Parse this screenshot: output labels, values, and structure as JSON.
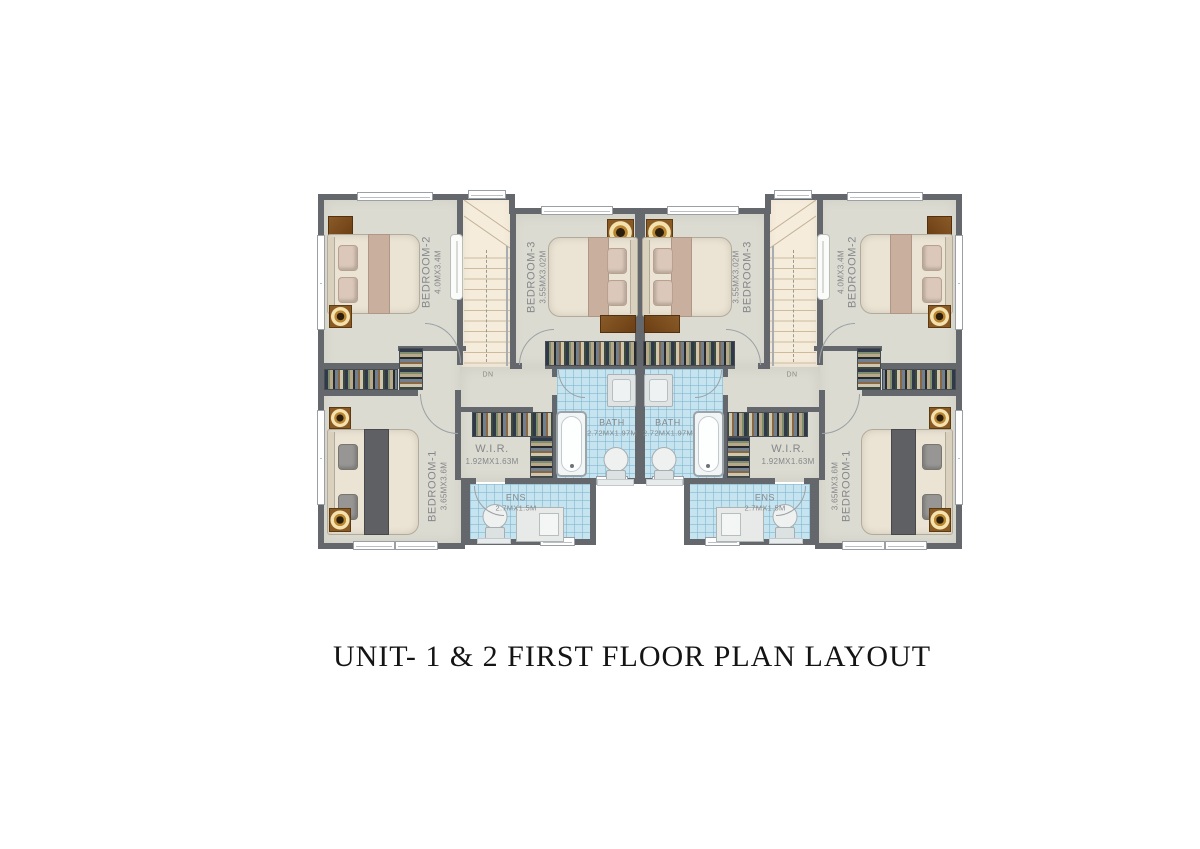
{
  "title": "UNIT- 1 & 2 FIRST FLOOR PLAN LAYOUT",
  "plan": {
    "stairs_label": "DN",
    "units": [
      {
        "id": "unit-1",
        "side": "left"
      },
      {
        "id": "unit-2",
        "side": "right"
      }
    ],
    "rooms": {
      "bedroom1": {
        "name": "BEDROOM-1",
        "dims": "3.65MX3.6M"
      },
      "bedroom2": {
        "name": "BEDROOM-2",
        "dims": "4.0MX3.4M"
      },
      "bedroom3": {
        "name": "BEDROOM-3",
        "dims": "3.55MX3.02M"
      },
      "wir": {
        "name": "W.I.R.",
        "dims": "1.92MX1.63M"
      },
      "bath": {
        "name": "BATH",
        "dims": "2.72MX1.97M"
      },
      "ens": {
        "name": "ENS",
        "dims": "2.7MX1.5M"
      }
    },
    "colors": {
      "floor": "#dbdbd1",
      "wall": "#64676c",
      "stair_floor": "#f5ecdc",
      "bath_tile": "#c6e4f0",
      "wood": "#7a4e20",
      "lamp_gold": "#e8c050"
    }
  }
}
